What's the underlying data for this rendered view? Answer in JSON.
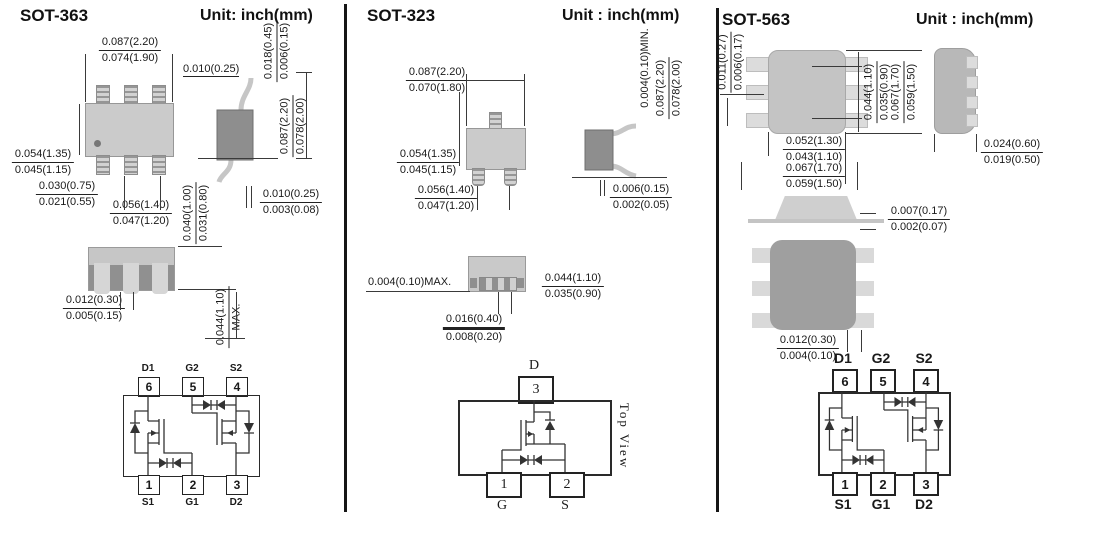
{
  "sot363": {
    "title": "SOT-363",
    "unit": "Unit: inch(mm)",
    "front": {
      "width_max": "0.087(2.20)",
      "width_min": "0.074(1.90)",
      "height_max": "0.054(1.35)",
      "height_min": "0.045(1.15)",
      "lead_max": "0.030(0.75)",
      "lead_min": "0.021(0.55)",
      "pitch_max": "0.056(1.40)",
      "pitch_min": "0.047(1.20)"
    },
    "side": {
      "foot": "0.010(0.25)",
      "lead_thk_max": "0.018(0.45)",
      "lead_thk_min": "0.006(0.15)",
      "height_max": "0.087(2.20)",
      "height_min": "0.078(2.00)",
      "standoff_max": "0.010(0.25)",
      "standoff_min": "0.003(0.08)"
    },
    "bottom": {
      "body_thk_max": "0.040(1.00)",
      "body_thk_min": "0.031(0.80)",
      "total_max": "0.044(1.10)",
      "total_suffix": "MAX.",
      "pad_max": "0.012(0.30)",
      "pad_min": "0.005(0.15)"
    },
    "pins": {
      "top": [
        {
          "name": "D1",
          "num": "6"
        },
        {
          "name": "G2",
          "num": "5"
        },
        {
          "name": "S2",
          "num": "4"
        }
      ],
      "bottom": [
        {
          "name": "S1",
          "num": "1"
        },
        {
          "name": "G1",
          "num": "2"
        },
        {
          "name": "D2",
          "num": "3"
        }
      ]
    }
  },
  "sot323": {
    "title": "SOT-323",
    "unit": "Unit : inch(mm)",
    "front": {
      "width_max": "0.087(2.20)",
      "width_min": "0.070(1.80)",
      "height_max": "0.054(1.35)",
      "height_min": "0.045(1.15)",
      "pitch_max": "0.056(1.40)",
      "pitch_min": "0.047(1.20)"
    },
    "side": {
      "min_clearance": "0.004(0.10)MIN.",
      "height_max": "0.087(2.20)",
      "height_min": "0.078(2.00)",
      "standoff_max": "0.006(0.15)",
      "standoff_min": "0.002(0.05)"
    },
    "bottom": {
      "max_clearance": "0.004(0.10)MAX.",
      "height_max": "0.044(1.10)",
      "height_min": "0.035(0.90)",
      "pad_max": "0.016(0.40)",
      "pad_min": "0.008(0.20)"
    },
    "pins": {
      "top": [
        {
          "name": "D",
          "num": "3"
        }
      ],
      "bottom": [
        {
          "name": "G",
          "num": "1"
        },
        {
          "name": "S",
          "num": "2"
        }
      ]
    },
    "view_label": "Top View"
  },
  "sot563": {
    "title": "SOT-563",
    "unit": "Unit : inch(mm)",
    "top": {
      "pad_max": "0.011(0.27)",
      "pad_min": "0.006(0.17)",
      "inner_max": "0.044(1.10)",
      "inner_min": "0.035(0.90)",
      "outer_max": "0.067(1.70)",
      "outer_min": "0.059(1.50)",
      "body_w_max": "0.052(1.30)",
      "body_w_min": "0.043(1.10)",
      "total_w_max": "0.067(1.70)",
      "total_w_min": "0.059(1.50)"
    },
    "side": {
      "depth_max": "0.024(0.60)",
      "depth_min": "0.019(0.50)"
    },
    "profile": {
      "lead_max": "0.007(0.17)",
      "lead_min": "0.002(0.07)"
    },
    "bottom": {
      "pad_max": "0.012(0.30)",
      "pad_min": "0.004(0.10)"
    },
    "pins": {
      "top": [
        {
          "name": "D1",
          "num": "6"
        },
        {
          "name": "G2",
          "num": "5"
        },
        {
          "name": "S2",
          "num": "4"
        }
      ],
      "bottom": [
        {
          "name": "S1",
          "num": "1"
        },
        {
          "name": "G1",
          "num": "2"
        },
        {
          "name": "D2",
          "num": "3"
        }
      ]
    }
  }
}
